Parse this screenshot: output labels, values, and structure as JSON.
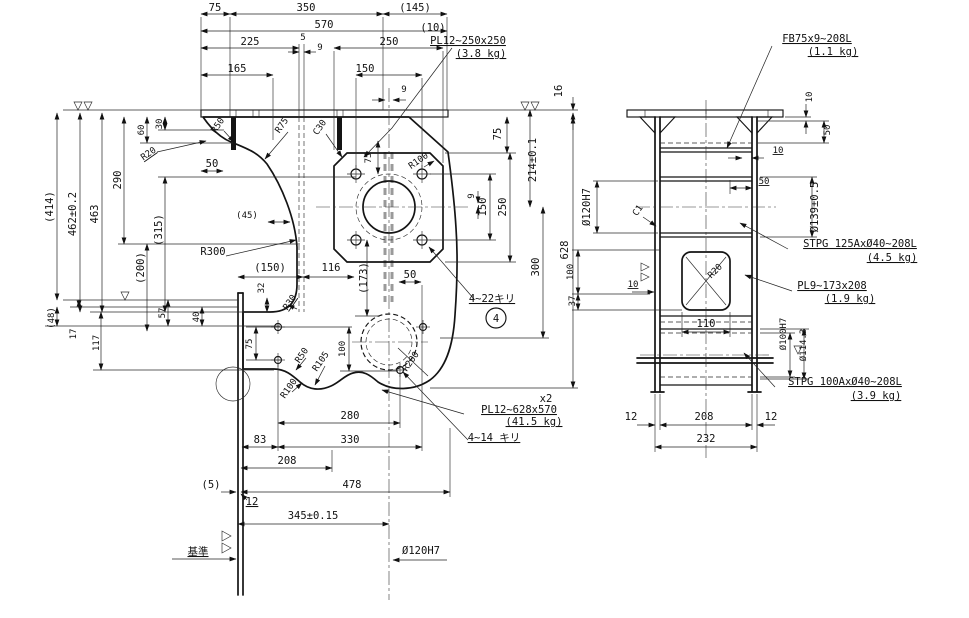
{
  "drawing_type": "engineering-drawing",
  "front": {
    "top": {
      "d75": "75",
      "d350": "350",
      "d145": "(145)",
      "d570": "570",
      "d225": "225",
      "d5": "5",
      "d9": "9",
      "d250": "250",
      "d165": "165",
      "d150": "150",
      "d9b": "9",
      "d16": "16"
    },
    "left": {
      "d414": "(414)",
      "d462": "462±0.2",
      "d463": "463",
      "d290": "290",
      "d315": "(315)",
      "d200": "(200)",
      "d60": "60",
      "d30": "30",
      "d50": "50",
      "r20": "R20",
      "r50": "R50",
      "r300": "R300",
      "r75": "R75",
      "c30": "C30",
      "d48": "(48)",
      "d17": "17",
      "d117": "117",
      "d57": "57",
      "d40": "40",
      "d32": "32"
    },
    "mid": {
      "d45": "(45)",
      "d150": "(150)",
      "d116": "116",
      "d173": "(173)",
      "d50": "50",
      "d75": "75",
      "r100": "R100",
      "r30": "R30",
      "r50": "R50",
      "r105": "R105",
      "r100b": "R100",
      "r200": "R200",
      "d75b": "75",
      "d100": "100"
    },
    "right": {
      "d75": "75",
      "d214": "214±0.1",
      "d9": "9",
      "d150": "150",
      "d250": "250",
      "d300": "300",
      "d628": "628"
    },
    "bottom": {
      "d280": "280",
      "d83": "83",
      "d330": "330",
      "d208": "208",
      "d5": "(5)",
      "d478": "478",
      "d12": "12",
      "d345": "345±0.15",
      "datum": "基準",
      "dia120": "Ø120H7"
    },
    "callouts": {
      "qty10": "(10)",
      "pl250": "PL12~250x250",
      "pl250w": "(3.8 kg)",
      "drill22": "4~22キリ",
      "balloon": "4",
      "x2": "x2",
      "pl628": "PL12~628x570",
      "pl628w": "(41.5 kg)",
      "drill14": "4~14 キリ"
    }
  },
  "side": {
    "callouts": {
      "fb75": "FB75x9~208L",
      "fb75w": "(1.1 kg)",
      "stpg125": "STPG 125AxØ40~208L",
      "stpg125w": "(4.5 kg)",
      "pl9": "PL9~173x208",
      "pl9w": "(1.9 kg)",
      "stpg100": "STPG 100AxØ40~208L",
      "stpg100w": "(3.9 kg)"
    },
    "dims": {
      "d10a": "10",
      "d50a": "50",
      "d10b": "10",
      "d50b": "50",
      "dia120": "Ø120H7",
      "c1": "C1",
      "dia139": "Ø139±0.5",
      "d110": "110",
      "dia100": "Ø100H7",
      "dia114": "Ø114.3",
      "r20": "R20",
      "d10c": "10",
      "d100": "100",
      "d37": "37",
      "d12l": "12",
      "d208": "208",
      "d12r": "12",
      "d232": "232"
    }
  }
}
